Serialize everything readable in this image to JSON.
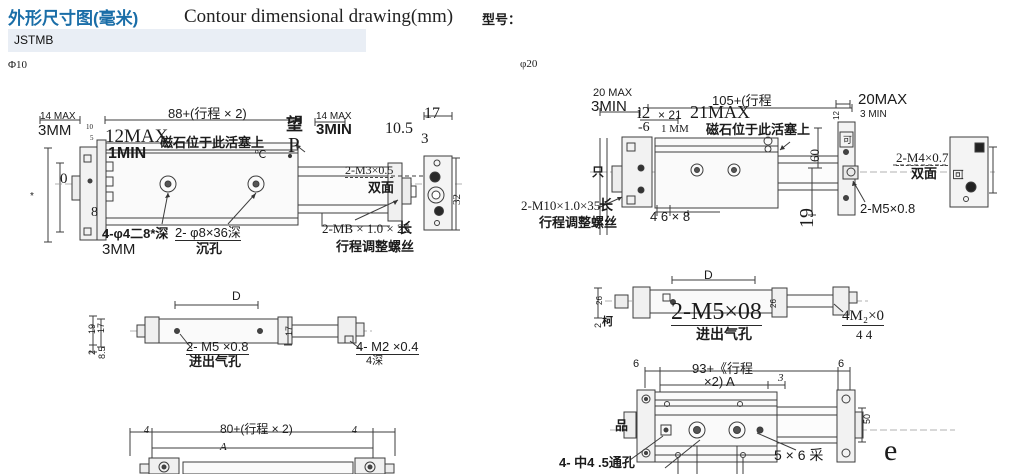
{
  "header": {
    "title_cn": "外形尺寸图(毫米)",
    "title_en": "Contour dimensional drawing(mm)",
    "model_label": "型号：",
    "model_value": "JSTMB"
  },
  "colors": {
    "title_blue": "#1a6ea8",
    "model_strip_bg": "#e9eef5",
    "line_color": "#3d3d3d"
  },
  "phi10": {
    "label": "Φ10",
    "front": {
      "dim_14max": "14  MAX",
      "dim_3mm": "3MM",
      "dim_88": "88+(行程 × 2)",
      "dim_12max": "12MAX",
      "dim_1min": "1MIN",
      "magnet_note": "磁石位于此活塞上",
      "wang": "望",
      "p": "P",
      "dim_14max_r": "14  MAX",
      "dim_3min": "3MIN",
      "dim_10_5": "10.5",
      "dim_17": "17",
      "dim_3": "3",
      "deg_c": "℃",
      "dim_0": "0",
      "dim_8": "8",
      "dim_10": "10",
      "dim_5": "5",
      "star": "*",
      "holes_note": "4-φ4二8*深",
      "holes_note2": "3MM",
      "sink_note": "2- φ8×36深",
      "sink_note2": "沉孔",
      "thread_note": "2-M3×0.5",
      "thread_note2": "双面",
      "adjust_note": "2-MB × 1.0 × 25",
      "adjust_long": "长",
      "adjust_note2": "行程调整螺丝",
      "dim_32": "32"
    },
    "middle": {
      "dim_d": "D",
      "dim_19": "19",
      "dim_17l": "17",
      "dim_2": "2",
      "dim_8_5": "8.5",
      "dim_17m": "17",
      "port_note": "2- M5 ×0.8",
      "port_note2": "进出气孔",
      "thread_note": "4- M2 ×0.4",
      "thread_note2": "4深"
    },
    "bottom": {
      "dim_4l": "4",
      "dim_80": "80+(行程 × 2)",
      "dim_4r": "4",
      "dim_a": "A"
    }
  },
  "phi20": {
    "label": "φ20",
    "front": {
      "dim_20max": "20  MAX",
      "dim_3min": "3MIN",
      "dim_i2": "i2",
      "dim_x21": "× 21",
      "dim_21max": "21MAX",
      "dim_105": "105+(行程",
      "dim_m6": "-6",
      "dim_1mm": "1  MM",
      "magnet_note": "磁石位于此活塞上",
      "dim_20max_r": "20MAX",
      "dim_3min_r": "3   MIN",
      "dim_12": "12",
      "ke": "可",
      "dim_60": "60",
      "dim_19": "19",
      "thread_note": "2-M4×0.7",
      "thread_note2": "双面",
      "hui": "回",
      "thread_m5": "2-M5×0.8",
      "zhi": "只",
      "adjust_note": "2-M10×1.0×35",
      "adjust_long": "长",
      "adjust_note2": "行程调整螺丝",
      "dim_468": "4   6   ×   8"
    },
    "middle": {
      "dim_d": "D",
      "dim_26l": "26",
      "dim_2": "2",
      "ke2": "柯",
      "dim_26m": "26",
      "port_note": "2-M5×08",
      "port_note2": "进出气孔",
      "thread_note": "4M₂×0",
      "thread_note2": "4 4"
    },
    "bottom": {
      "dim_6l": "6",
      "dim_93": "93+《行程",
      "dim_93b": "×2)  A",
      "dim_3": "3",
      "dim_6r": "6",
      "pin": "品",
      "dim_50": "50",
      "holes_note": "4- 中4 .5通孔",
      "note_5x6": "5  ×  6 采",
      "e": "e"
    }
  }
}
